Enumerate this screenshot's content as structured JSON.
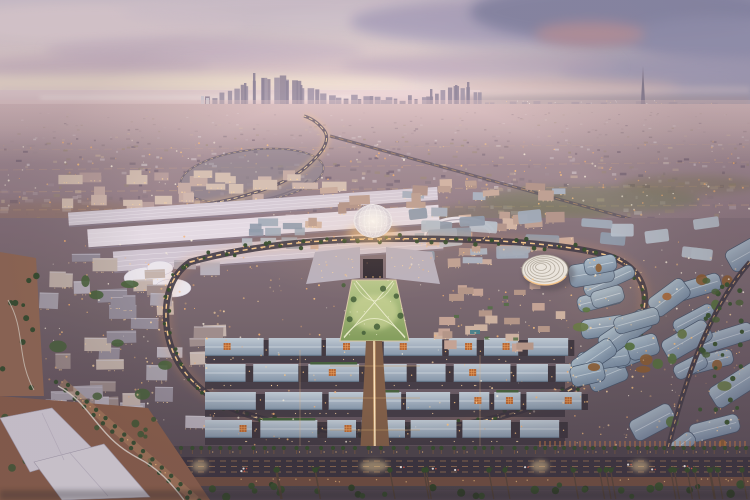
{
  "meta": {
    "type": "photorealistic-aerial-render",
    "time_of_day": "dusk",
    "subject": "master-planned expo district viewed from the air with a distant city skyline"
  },
  "scene": {
    "landmarks": [
      {
        "name": "sunset-sky",
        "desc": "pale pink dusk sky with lavender and slate clouds"
      },
      {
        "name": "sea-horizon",
        "desc": "pale sea meeting the sky at the upper left"
      },
      {
        "name": "distant-city-skyline",
        "desc": "cluster of high-rise silhouettes on the horizon"
      },
      {
        "name": "needle-spire-tower",
        "desc": "slender spire tower on the right horizon"
      },
      {
        "name": "urban-sprawl",
        "desc": "hazy low-rise city between horizon and site"
      },
      {
        "name": "elevated-highway",
        "desc": "lit elevated roadway curving into the site"
      },
      {
        "name": "exhibition-halls",
        "desc": "long white halls along the north edge of the site"
      },
      {
        "name": "central-lattice-dome",
        "desc": "white domed trellis at the heart of the site"
      },
      {
        "name": "central-park",
        "desc": "illuminated green lawn with crossing light paths"
      },
      {
        "name": "spiral-roof-pavilion",
        "desc": "round pavilion with concentric spiral roof"
      },
      {
        "name": "ring-road",
        "desc": "illuminated loop street around the core"
      },
      {
        "name": "pavilion-roof-rows",
        "desc": "rows of gabled blue-grey pavilion roofs"
      },
      {
        "name": "main-avenue",
        "desc": "brightly lit avenue running toward the foreground"
      },
      {
        "name": "palm-lined-boulevard",
        "desc": "foreground boulevard with palms and traffic"
      },
      {
        "name": "white-event-sheds",
        "desc": "large white flat roofs at the lower left"
      }
    ]
  },
  "palette": {
    "sky": {
      "top": "#ddd4e2",
      "mid": "#f0dedd",
      "horizon": "#f8e7dc",
      "cool": "#8e92b7",
      "cloud_pink": "#f2e2e8",
      "cloud_lavender": "#d5c3d6",
      "cloud_slate": "#8b8fb3",
      "cloud_rose": "#c79fa8",
      "glow": "#f9ead9"
    },
    "sea": {
      "top": "#f0dbdd",
      "bottom": "#ddc3c8",
      "shine": "#f6e8e6"
    },
    "skyline": {
      "silhouette": "#a196ac",
      "silhouette2": "#948aa0",
      "white_tower": "#d8d3dc",
      "spire": "#8e869c"
    },
    "sprawl": {
      "top": "#c2abb2",
      "mid": "#a28c95",
      "bottom": "#8b7681",
      "tex": [
        "#cfc3c9",
        "#b7a5ad",
        "#a28e97",
        "#8c7a84",
        "#746476",
        "#c2ab9e",
        "#9d8b7d"
      ],
      "green": "#6f7a55",
      "desert": "#96735c",
      "road": "#d7ae8a"
    },
    "site": {
      "ground_top": "#85727c",
      "ground_bottom": "#4d4350",
      "street": "#2e2933",
      "hall": "#e4dce6",
      "hall2": "#d0c7d4",
      "hall3": "#d6cdd9",
      "resid": [
        "#c6aca6",
        "#cfb7ae",
        "#b89e9e",
        "#d5c0b4"
      ],
      "plaza": [
        "#c9ab9e",
        "#bda093",
        "#d2b5a5",
        "#b2948b",
        "#a9b2c0"
      ],
      "west": [
        "#a7a2ae",
        "#938c9b",
        "#b6b0bc",
        "#c3b4ad",
        "#9b8b8b"
      ],
      "beige": [
        "#c2a294",
        "#b29486",
        "#cbb0a0"
      ],
      "ne": [
        "#9fabba",
        "#8d9aac",
        "#b6c0cc"
      ],
      "roof_top": "#bcc8d4",
      "roof_bottom": "#8093a8",
      "roof_east_top": "#a9bccb",
      "roof_east_bottom": "#758ba4",
      "roof_edge": "#3f5068",
      "ridge": "#d8e0e8",
      "lattice": "#b5622e",
      "lattice2": "#e8a05c"
    },
    "landscape": {
      "palm": "#2e4929",
      "palm_dark": "#263c20",
      "tree": "#3a5530",
      "lawn_top": "#b6c98b",
      "lawn_bottom": "#7e9b58",
      "lawn_glow": "#cdd898",
      "courtyard": [
        "#507038",
        "#a56432",
        "#8a5a2e",
        "#60753f"
      ],
      "terrain": "#8a5d48",
      "terrain2": "#936852",
      "path": "#e9e2d8",
      "pool": "#3f7d8a"
    },
    "structures": {
      "dome_hi": "#faf8f4",
      "dome_lo": "#cfc9d6",
      "spiral": "#eae6df",
      "spiral_ring": "#b2ab9f",
      "shed": "#dedae6",
      "shed_edge": "#aaa5b8",
      "canopy": "#ebe8f0",
      "arena": "#e7e3eb",
      "entry": "#27232e"
    },
    "lights": {
      "warm": "#ffd9a4",
      "amber": "#ffc57e",
      "deep": "#f7b170",
      "white": "#fff6e3",
      "street_glow": "#ffca82",
      "median": "#ffd08f",
      "post": "#d97e3f",
      "car_tail": "#e85742",
      "road_lane": "#d89a5e"
    },
    "roads": {
      "ring": "#3c3642",
      "asphalt": "#332e3a",
      "boulevard": "#474049",
      "sidewalk": "#6b4a3c",
      "avenue": "#7c5a44",
      "highway": "#675c6b"
    },
    "atmosphere": {
      "haze": "#eccfce",
      "vignette": "#3a2c3c",
      "glow": "#ffc27a"
    }
  }
}
